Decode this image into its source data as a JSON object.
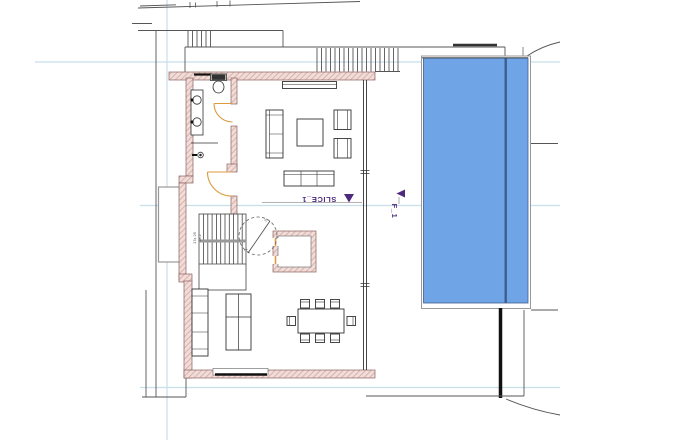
{
  "drawing_type": "architectural floor plan with pool",
  "markers": {
    "slice_label": "SLICE_1",
    "f_label": "F_1",
    "stair_note_1": "17x 25",
    "stair_note_2": "18,2",
    "circle_note_1": "2x",
    "circle_note_2": "2x"
  },
  "colors": {
    "wall_fill": "#f0dcd8",
    "wall_hatch": "#d2a09a",
    "wall_stroke": "#8a6360",
    "pool_fill": "#6fa5e6",
    "pool_stroke": "#3f5d8f",
    "door_orange": "#dd9a3e",
    "marker_purple": "#4e2a7e",
    "construction_cyan": "#c8dfea",
    "line_dark": "#555555",
    "line_gray": "#999999",
    "line_black": "#111111"
  }
}
